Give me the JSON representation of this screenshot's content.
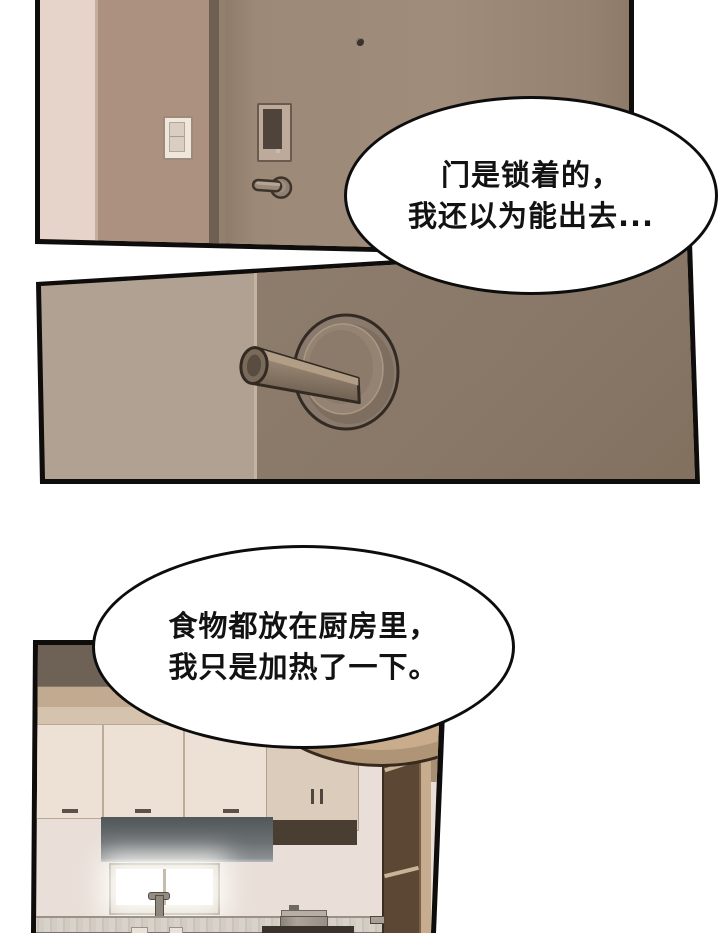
{
  "page": {
    "kind": "webtoon comic page",
    "background": "#ffffff"
  },
  "panels": [
    {
      "id": "panel-1",
      "label": "entrance door with keypad lock, light switch and peephole"
    },
    {
      "id": "panel-2",
      "label": "close-up of locked door lever handle"
    },
    {
      "id": "panel-3",
      "label": "kitchen with cabinets, range hood, bright window and pot on stove"
    }
  ],
  "speech_bubbles": [
    {
      "id": "bubble-1",
      "lines": [
        "门是锁着的，",
        "我还以为能出去..."
      ]
    },
    {
      "id": "bubble-2",
      "lines": [
        "食物都放在厨房里，",
        "我只是加热了一下。"
      ]
    }
  ],
  "palette": {
    "panel_border": "#0e0d0b",
    "bubble_outline": "#0d0d0d",
    "wall_light": "#e6d4ca",
    "wall_brown": "#ac9080",
    "door_panel1": "#9d8977",
    "door_panel2": "#897868",
    "door_strip_light": "#b1a192",
    "handle_metal": "#948373",
    "kitchen_cabinet": "#ece1d4",
    "kitchen_hood": "#5a5f62",
    "kitchen_soffit_dark": "#6e6257",
    "kitchen_bulkhead_tan": "#c8ac8c",
    "kitchen_door_brown": "#5c4734",
    "window_light": "#ffffff"
  }
}
